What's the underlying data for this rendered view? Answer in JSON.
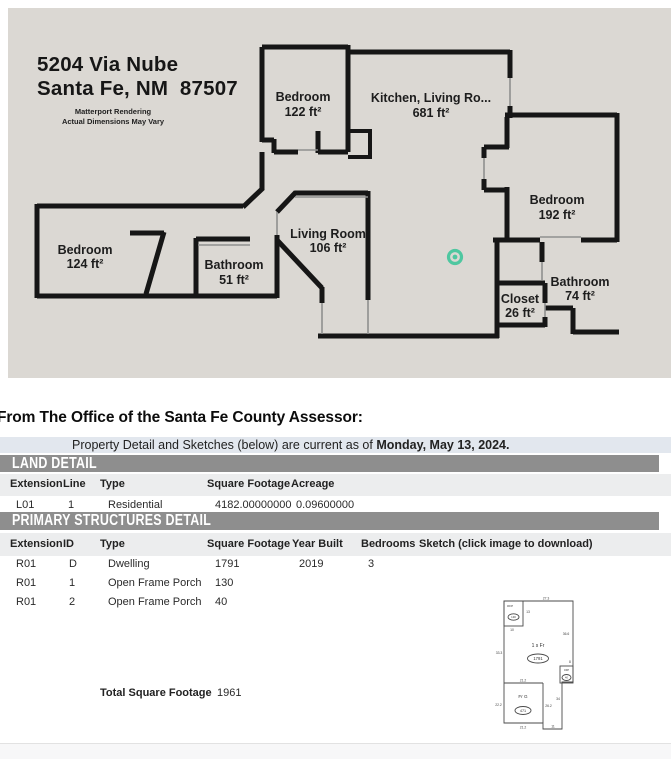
{
  "floor_plan": {
    "bg_color": "#dbd8d3",
    "wall_color": "#161616",
    "marker_color": "#4fc7a0",
    "address_line1": "5204 Via Nube",
    "address_line2": "Santa Fe, NM  87507",
    "note_line1": "Matterport Rendering",
    "note_line2": "Actual Dimensions May Vary",
    "rooms": [
      {
        "name": "Bedroom",
        "area": "122 ft²"
      },
      {
        "name": "Kitchen, Living Ro...",
        "area": "681 ft²"
      },
      {
        "name": "Bedroom",
        "area": "192 ft²"
      },
      {
        "name": "Bedroom",
        "area": "124 ft²"
      },
      {
        "name": "Bathroom",
        "area": "51 ft²"
      },
      {
        "name": "Living Room",
        "area": "106 ft²"
      },
      {
        "name": "Bathroom",
        "area": "74 ft²"
      },
      {
        "name": "Closet",
        "area": "26 ft²"
      }
    ]
  },
  "assessor": {
    "heading": "From The Office of the Santa Fe County Assessor:",
    "notice": {
      "prefix": "Property Detail and Sketches (below) are current as of ",
      "date_bold": "Monday, May 13, 2024."
    },
    "section_bar_color": "#8e8e8e",
    "land_detail": {
      "title": "LAND DETAIL",
      "columns": [
        "Extension",
        "Line",
        "Type",
        "Square Footage",
        "Acreage"
      ],
      "rows": [
        [
          "L01",
          "1",
          "Residential",
          "4182.00000000",
          "0.09600000"
        ]
      ]
    },
    "primary_structures": {
      "title": "PRIMARY STRUCTURES DETAIL",
      "columns": [
        "Extension",
        "ID",
        "Type",
        "Square Footage",
        "Year Built",
        "Bedrooms",
        "Sketch (click image to download)"
      ],
      "rows": [
        [
          "R01",
          "D",
          "Dwelling",
          "1791",
          "2019",
          "3"
        ],
        [
          "R01",
          "1",
          "Open Frame Porch",
          "130",
          "",
          ""
        ],
        [
          "R01",
          "2",
          "Open Frame Porch",
          "40",
          "",
          ""
        ]
      ],
      "total_label": "Total Square Footage",
      "total_value": "1961"
    },
    "sketch": {
      "house_label": "1 s Fr",
      "house_value": "1791",
      "garage_label": "Fr G",
      "garage_value": "471",
      "porch_top_label": "OFP",
      "porch_top_value": "130",
      "porch_right_label": "OFP",
      "porch_right_value": "40",
      "dims": {
        "top": "27.3",
        "porch_side": "13",
        "porch_bottom": "10",
        "right_upper": "36.6",
        "left_upper": "33.3",
        "right_mid": "8",
        "strip_side": "34",
        "garage_top": "21.2",
        "garage_left": "22.2",
        "garage_right": "26.2",
        "garage_bottom": "21.2",
        "strip_bottom": "11"
      }
    }
  }
}
